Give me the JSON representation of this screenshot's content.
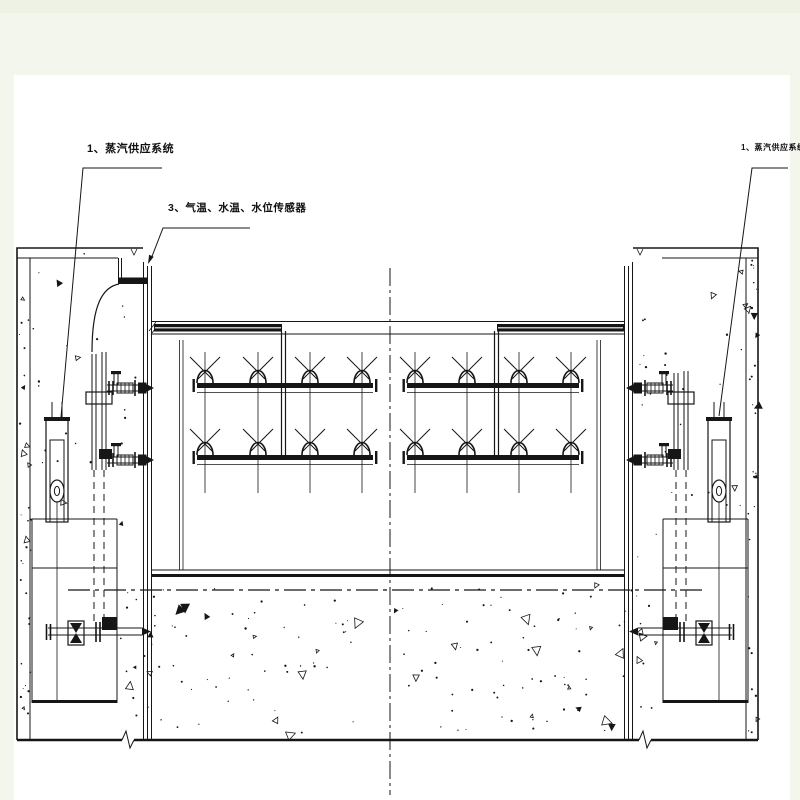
{
  "drawing": {
    "type": "engineering-section-drawing",
    "subject": "gate steam-heating and sensor piping section",
    "colors": {
      "margin_bg": "#f3f6ec",
      "paper": "#ffffff",
      "ink": "#161616"
    }
  },
  "annotations": [
    {
      "id": "steam-supply-left",
      "text": "1、蒸汽供应系统"
    },
    {
      "id": "sensors",
      "text": "3、气温、水温、水位传感器"
    },
    {
      "id": "steam-supply-right",
      "text": "1、蒸汽供应系统"
    }
  ],
  "symbols": {
    "valve": "valve-icon",
    "flow_arrow": "flow-arrow-icon",
    "break_line": "break-line-icon",
    "centerline": "centerline-dash-dot",
    "concrete": "concrete-stipple-texture"
  }
}
